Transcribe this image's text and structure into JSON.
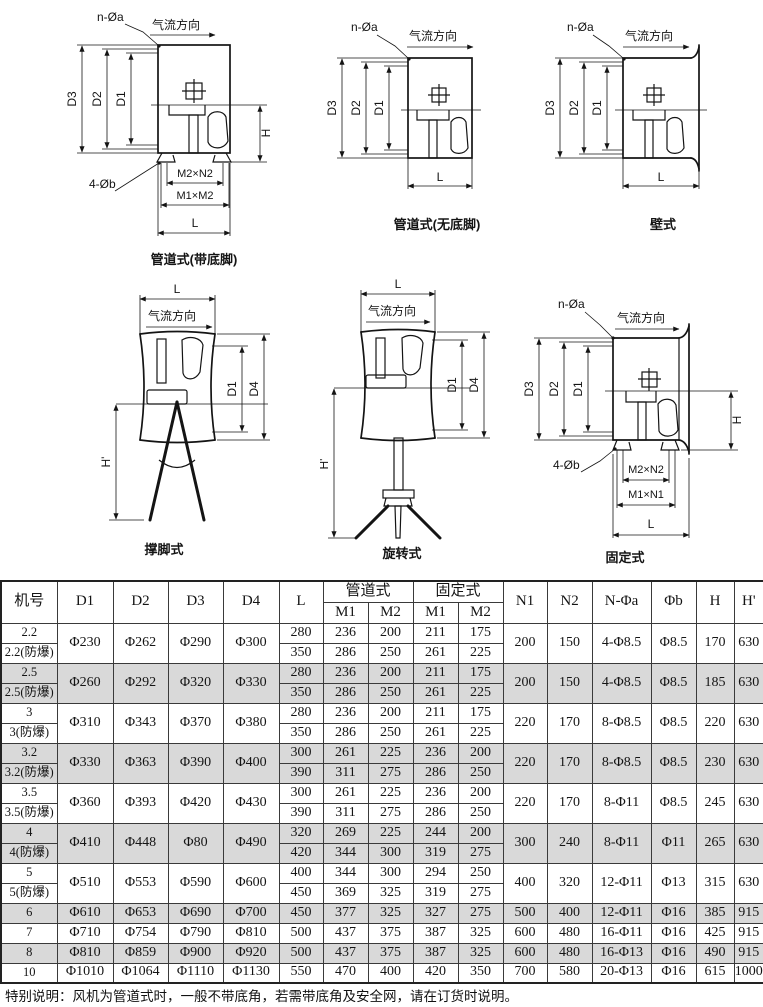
{
  "diagrams": [
    {
      "caption": "管道式(带底脚)",
      "airflow": "气流方向",
      "hole_top": "n-Øa",
      "hole_bottom": "4-Øb",
      "dims": {
        "d1": "D1",
        "d2": "D2",
        "d3": "D3",
        "h": "H",
        "l": "L",
        "m2n2": "M2×N2",
        "m1m2": "M1×M2"
      }
    },
    {
      "caption": "管道式(无底脚)",
      "airflow": "气流方向",
      "hole_top": "n-Øa",
      "dims": {
        "d1": "D1",
        "d2": "D2",
        "d3": "D3",
        "l": "L"
      }
    },
    {
      "caption": "壁式",
      "airflow": "气流方向",
      "hole_top": "n-Øa",
      "dims": {
        "d1": "D1",
        "d2": "D2",
        "d3": "D3",
        "l": "L"
      }
    },
    {
      "caption": "撑脚式",
      "airflow": "气流方向",
      "dims": {
        "l": "L",
        "d1": "D1",
        "d4": "D4",
        "hp": "H'"
      }
    },
    {
      "caption": "旋转式",
      "airflow": "气流方向",
      "dims": {
        "l": "L",
        "d1": "D1",
        "d4": "D4",
        "hp": "H'"
      }
    },
    {
      "caption": "固定式",
      "airflow": "气流方向",
      "hole_top": "n-Øa",
      "hole_bottom": "4-Øb",
      "dims": {
        "d1": "D1",
        "d2": "D2",
        "d3": "D3",
        "h": "H",
        "l": "L",
        "m2n2": "M2×N2",
        "m1n1": "M1×N1"
      }
    }
  ],
  "table": {
    "header": {
      "jihao": "机号",
      "d1": "D1",
      "d2": "D2",
      "d3": "D3",
      "d4": "D4",
      "l": "L",
      "guandao": "管道式",
      "guding": "固定式",
      "m1a": "M1",
      "m2a": "M2",
      "m1b": "M1",
      "m2b": "M2",
      "n1": "N1",
      "n2": "N2",
      "nphia": "N-Φa",
      "phib": "Φb",
      "h": "H",
      "hp": "H'"
    },
    "groups": [
      {
        "shaded": false,
        "labels": [
          "2.2",
          "2.2(防爆)"
        ],
        "d": [
          "Φ230",
          "Φ262",
          "Φ290",
          "Φ300"
        ],
        "rows": [
          [
            "280",
            "236",
            "200",
            "211",
            "175"
          ],
          [
            "350",
            "286",
            "250",
            "261",
            "225"
          ]
        ],
        "tail": [
          "200",
          "150",
          "4-Φ8.5",
          "Φ8.5",
          "170",
          "630"
        ]
      },
      {
        "shaded": true,
        "labels": [
          "2.5",
          "2.5(防爆)"
        ],
        "d": [
          "Φ260",
          "Φ292",
          "Φ320",
          "Φ330"
        ],
        "rows": [
          [
            "280",
            "236",
            "200",
            "211",
            "175"
          ],
          [
            "350",
            "286",
            "250",
            "261",
            "225"
          ]
        ],
        "tail": [
          "200",
          "150",
          "4-Φ8.5",
          "Φ8.5",
          "185",
          "630"
        ]
      },
      {
        "shaded": false,
        "labels": [
          "3",
          "3(防爆)"
        ],
        "d": [
          "Φ310",
          "Φ343",
          "Φ370",
          "Φ380"
        ],
        "rows": [
          [
            "280",
            "236",
            "200",
            "211",
            "175"
          ],
          [
            "350",
            "286",
            "250",
            "261",
            "225"
          ]
        ],
        "tail": [
          "220",
          "170",
          "8-Φ8.5",
          "Φ8.5",
          "220",
          "630"
        ]
      },
      {
        "shaded": true,
        "labels": [
          "3.2",
          "3.2(防爆)"
        ],
        "d": [
          "Φ330",
          "Φ363",
          "Φ390",
          "Φ400"
        ],
        "rows": [
          [
            "300",
            "261",
            "225",
            "236",
            "200"
          ],
          [
            "390",
            "311",
            "275",
            "286",
            "250"
          ]
        ],
        "tail": [
          "220",
          "170",
          "8-Φ8.5",
          "Φ8.5",
          "230",
          "630"
        ]
      },
      {
        "shaded": false,
        "labels": [
          "3.5",
          "3.5(防爆)"
        ],
        "d": [
          "Φ360",
          "Φ393",
          "Φ420",
          "Φ430"
        ],
        "rows": [
          [
            "300",
            "261",
            "225",
            "236",
            "200"
          ],
          [
            "390",
            "311",
            "275",
            "286",
            "250"
          ]
        ],
        "tail": [
          "220",
          "170",
          "8-Φ11",
          "Φ8.5",
          "245",
          "630"
        ]
      },
      {
        "shaded": true,
        "labels": [
          "4",
          "4(防爆)"
        ],
        "d": [
          "Φ410",
          "Φ448",
          "Φ80",
          "Φ490"
        ],
        "rows": [
          [
            "320",
            "269",
            "225",
            "244",
            "200"
          ],
          [
            "420",
            "344",
            "300",
            "319",
            "275"
          ]
        ],
        "tail": [
          "300",
          "240",
          "8-Φ11",
          "Φ11",
          "265",
          "630"
        ]
      },
      {
        "shaded": false,
        "labels": [
          "5",
          "5(防爆)"
        ],
        "d": [
          "Φ510",
          "Φ553",
          "Φ590",
          "Φ600"
        ],
        "rows": [
          [
            "400",
            "344",
            "300",
            "294",
            "250"
          ],
          [
            "450",
            "369",
            "325",
            "319",
            "275"
          ]
        ],
        "tail": [
          "400",
          "320",
          "12-Φ11",
          "Φ13",
          "315",
          "630"
        ]
      },
      {
        "shaded": true,
        "labels": [
          "6"
        ],
        "d": [
          "Φ610",
          "Φ653",
          "Φ690",
          "Φ700"
        ],
        "rows": [
          [
            "450",
            "377",
            "325",
            "327",
            "275"
          ]
        ],
        "tail": [
          "500",
          "400",
          "12-Φ11",
          "Φ16",
          "385",
          "915"
        ]
      },
      {
        "shaded": false,
        "labels": [
          "7"
        ],
        "d": [
          "Φ710",
          "Φ754",
          "Φ790",
          "Φ810"
        ],
        "rows": [
          [
            "500",
            "437",
            "375",
            "387",
            "325"
          ]
        ],
        "tail": [
          "600",
          "480",
          "16-Φ11",
          "Φ16",
          "425",
          "915"
        ]
      },
      {
        "shaded": true,
        "labels": [
          "8"
        ],
        "d": [
          "Φ810",
          "Φ859",
          "Φ900",
          "Φ920"
        ],
        "rows": [
          [
            "500",
            "437",
            "375",
            "387",
            "325"
          ]
        ],
        "tail": [
          "600",
          "480",
          "16-Φ13",
          "Φ16",
          "490",
          "915"
        ]
      },
      {
        "shaded": false,
        "labels": [
          "10"
        ],
        "d": [
          "Φ1010",
          "Φ1064",
          "Φ1110",
          "Φ1130"
        ],
        "rows": [
          [
            "550",
            "470",
            "400",
            "420",
            "350"
          ]
        ],
        "tail": [
          "700",
          "580",
          "20-Φ13",
          "Φ16",
          "615",
          "1000"
        ]
      }
    ]
  },
  "note": "特别说明：风机为管道式时，一般不带底角，若需带底角及安全网，请在订货时说明。"
}
